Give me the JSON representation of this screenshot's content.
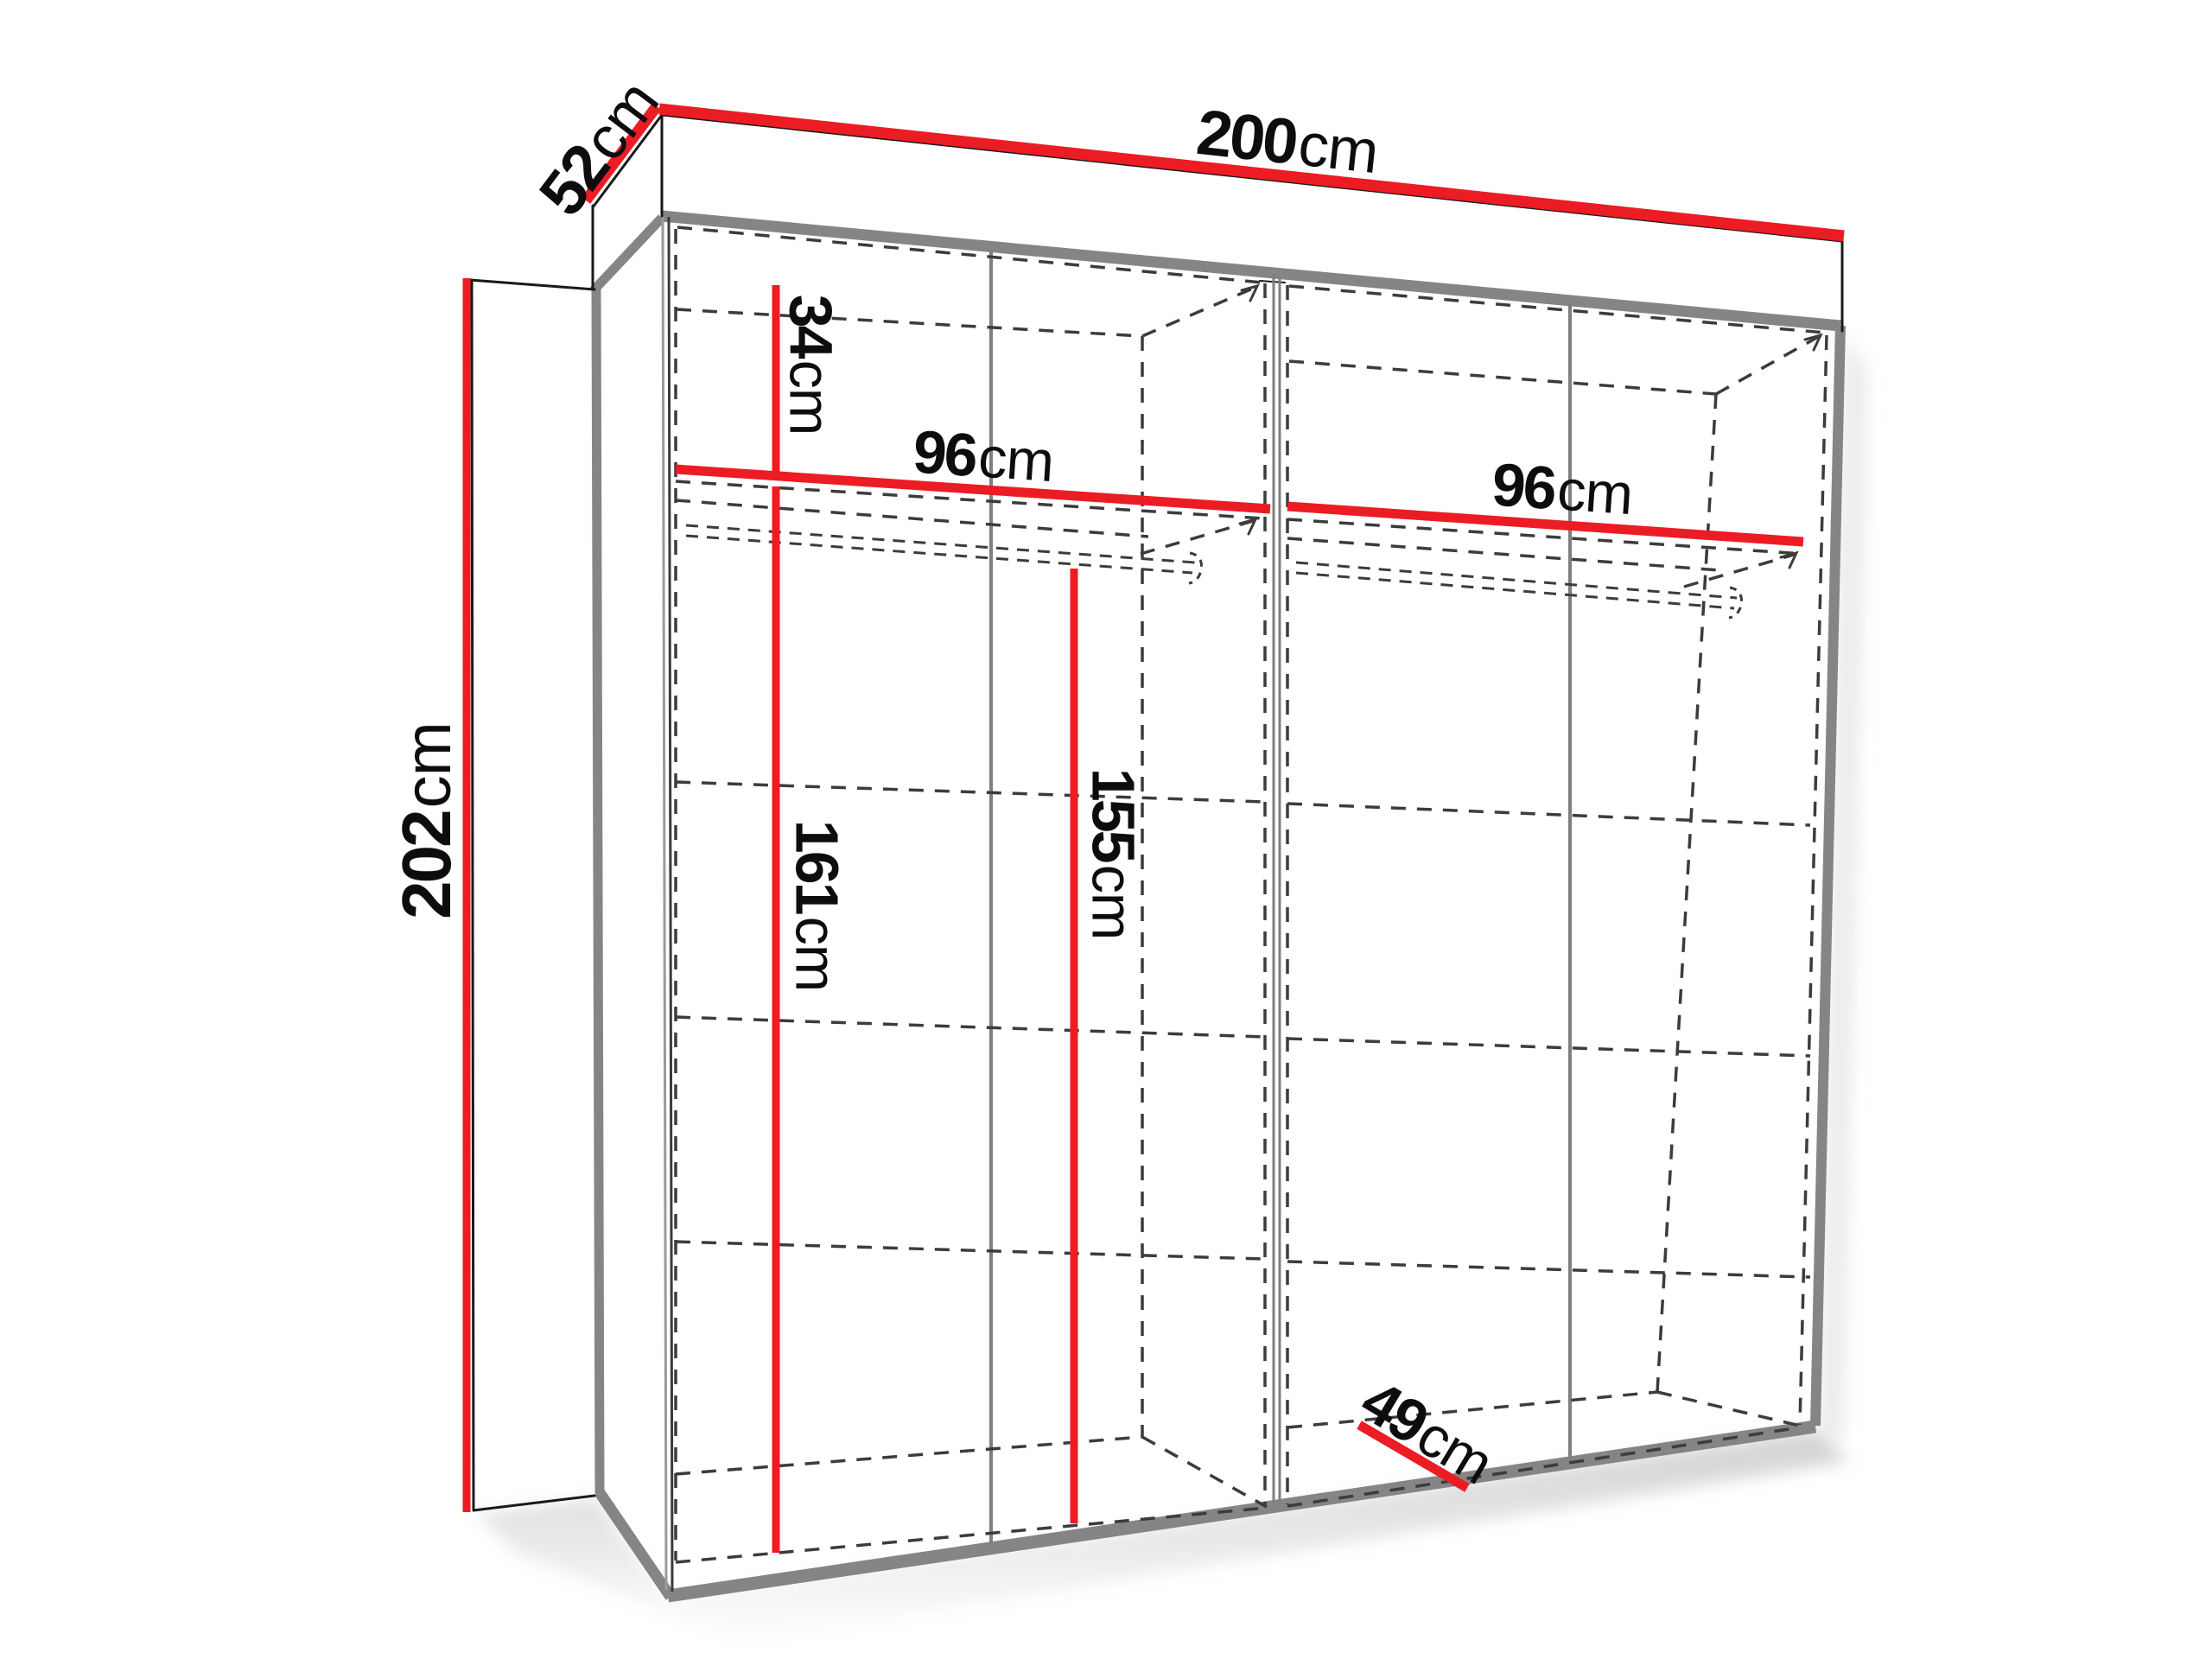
{
  "diagram": {
    "unit": "cm",
    "colors": {
      "dimension_red": "#ec1c24",
      "outline_black": "#1a1a1a",
      "edge_gray": "#858585",
      "hidden_dash_gray": "#3c3c3c"
    },
    "dimensions": {
      "width": {
        "value": "200",
        "unit": "cm"
      },
      "depth": {
        "value": "52",
        "unit": "cm"
      },
      "height": {
        "value": "202",
        "unit": "cm"
      },
      "top_shelf": {
        "value": "34",
        "unit": "cm"
      },
      "left_width": {
        "value": "96",
        "unit": "cm"
      },
      "right_width": {
        "value": "96",
        "unit": "cm"
      },
      "left_hang": {
        "value": "161",
        "unit": "cm"
      },
      "right_hang": {
        "value": "155",
        "unit": "cm"
      },
      "inner_depth": {
        "value": "49",
        "unit": "cm"
      }
    }
  }
}
